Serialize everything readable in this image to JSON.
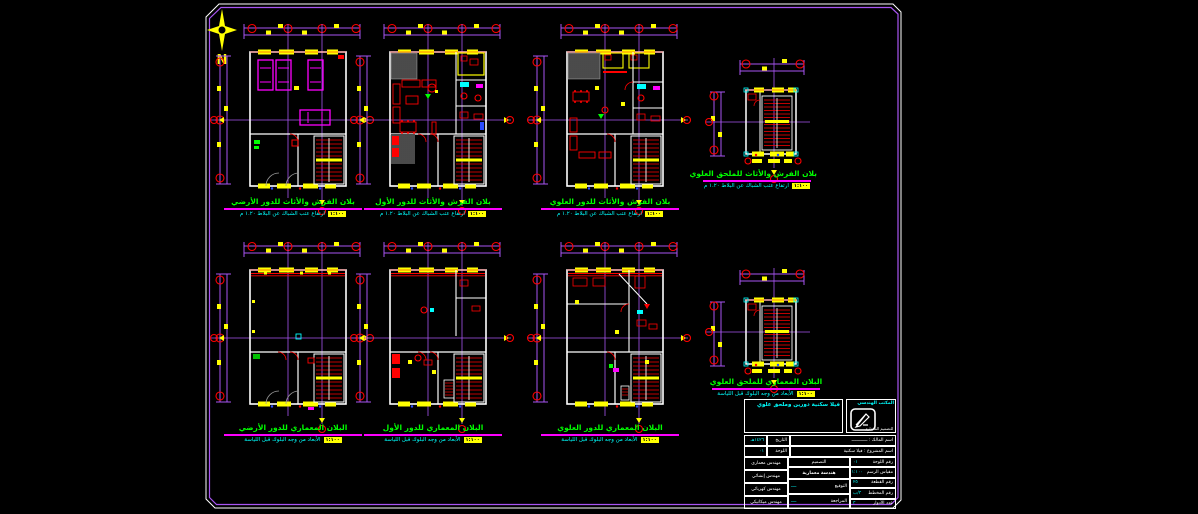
{
  "palette": {
    "background": "#000000",
    "frame": "#a95ef2",
    "walls": "#ffffff",
    "dimensions": "#a95ef2",
    "grid_bubbles": "#ff0000",
    "dimension_text": "#ffff00",
    "furniture": "#ff0000",
    "cars": "#ff00ff",
    "plan_titles": "#00ff00",
    "plan_subtitles": "#00ffff",
    "underline": "#ff00ff",
    "hatch": "#9a9a9a"
  },
  "north": {
    "label": "N"
  },
  "plans": [
    {
      "title": "بلان الفرش والأثاث للدور الأرضي",
      "sub": "ارتفاع عتب الشباك عن البلاط ١.٢٠ م",
      "scale": "١:١٠٠",
      "variant": "garage"
    },
    {
      "title": "بلان الفرش والأثاث للدور الأول",
      "sub": "ارتفاع عتب الشباك عن البلاط ١.٢٠ م",
      "scale": "١:١٠٠",
      "variant": "living"
    },
    {
      "title": "بلان الفرش والأثاث للدور العلوي",
      "sub": "ارتفاع عتب الشباك عن البلاط ١.٢٠ م",
      "scale": "١:١٠٠",
      "variant": "bedroom"
    },
    {
      "title": "بلان الفرش والأثاث للملحق العلوي",
      "sub": "ارتفاع عتب الشباك عن البلاط ١.٢٠ م",
      "scale": "١:١٠٠",
      "variant": "small"
    },
    {
      "title": "البلان المعماري للدور الأرضي",
      "sub": "الأبعاد من وجه البلوك قبل اللياسة",
      "scale": "١:١٠٠",
      "variant": "plainA"
    },
    {
      "title": "البلان المعماري للدور الأول",
      "sub": "الأبعاد من وجه البلوك قبل اللياسة",
      "scale": "١:١٠٠",
      "variant": "plainB"
    },
    {
      "title": "البلان المعماري للدور العلوي",
      "sub": "الأبعاد من وجه البلوك قبل اللياسة",
      "scale": "١:١٠٠",
      "variant": "plainC"
    },
    {
      "title": "البلان المعماري للملحق العلوي",
      "sub": "الأبعاد من وجه البلوك قبل اللياسة",
      "scale": "١:١٠٠",
      "variant": "small"
    }
  ],
  "title_block": {
    "project_title": "فيلا سكنية دورين وملحق علوي",
    "office_name": "المكتب الهندسي",
    "office_sub": "للتصميم المعماري",
    "row1_label": "اسم المالك",
    "row1_value": "ــــــــــــ",
    "row1_side_label": "التاريخ",
    "row1_side_value": "١٤٢٦هـ",
    "row2_label": "اسم المشروع",
    "row2_value": "فيلا سكنية",
    "row2_side_label": "اللوحة",
    "row2_side_value": "٠١",
    "engineers": [
      "مهندس معماري",
      "مهندس إنشائي",
      "مهندس كهربائي",
      "مهندس ميكانيكي"
    ],
    "mid_line1": "التصميم",
    "mid_line2": "هندسة معمارية",
    "mid_pairs": [
      {
        "label": "التوقيع",
        "value": "ــــ"
      },
      {
        "label": "المراجعة",
        "value": "ــــ"
      }
    ],
    "fields": [
      {
        "label": "رقم اللوحة",
        "value": "٠١"
      },
      {
        "label": "مقياس الرسم",
        "value": "١:١٠٠"
      },
      {
        "label": "رقم القطعة",
        "value": "٢٥"
      },
      {
        "label": "رقم المخطط",
        "value": "٣/ب"
      },
      {
        "label": "عدد الأدوار",
        "value": "٣"
      }
    ]
  }
}
